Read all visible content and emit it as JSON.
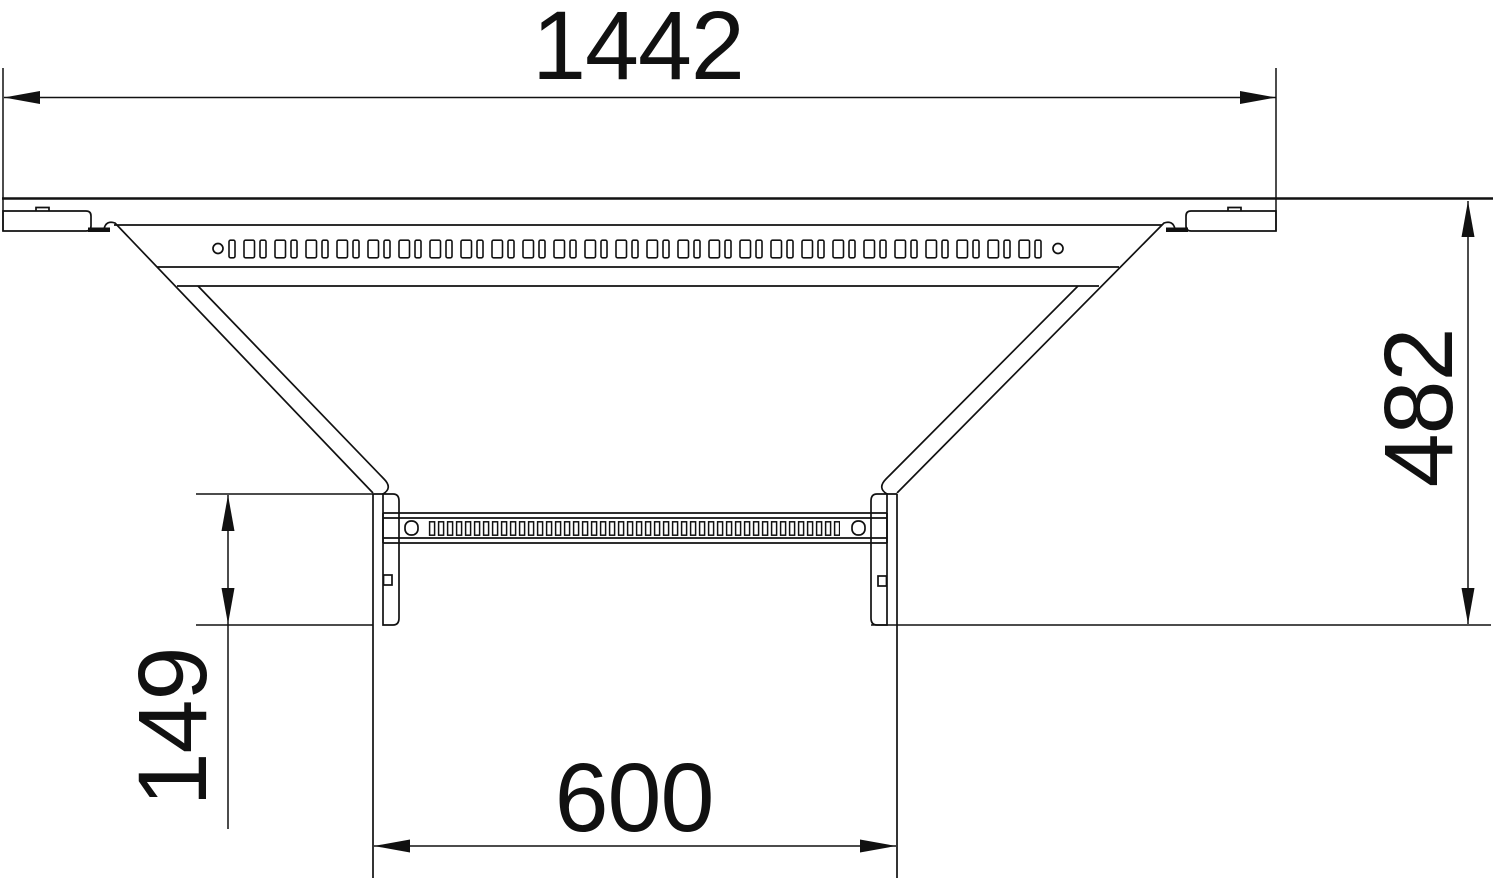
{
  "drawing": {
    "type": "technical-dimension-drawing",
    "subject": "cable-ladder-add-on-tee-top-view",
    "background_color": "#ffffff",
    "line_color": "#111111",
    "labels": {
      "overall_width": "1442",
      "overall_depth": "482",
      "branch_stub_length": "149",
      "branch_opening_width": "600"
    }
  }
}
